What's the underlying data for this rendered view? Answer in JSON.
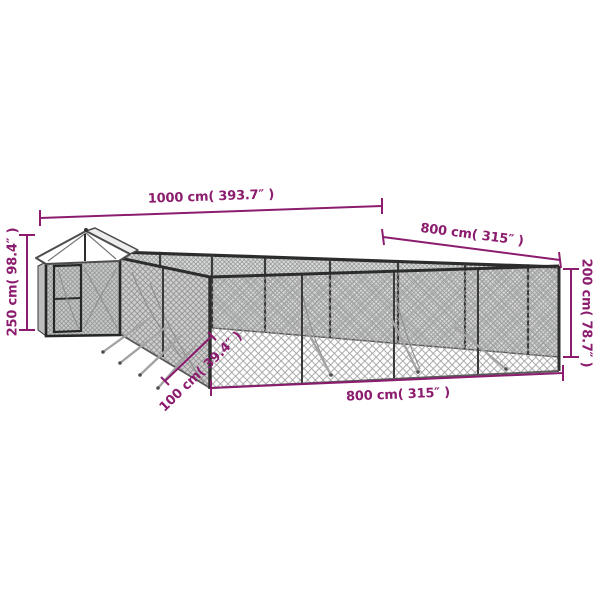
{
  "canvas": {
    "width": 600,
    "height": 600,
    "background_color": "#ffffff"
  },
  "diagram": {
    "illustration_name": "outdoor-chain-link-dog-kennel-with-gabled-roof-shelter",
    "accent_color": "#8b1c6e",
    "fence_mesh_color": "#9a9a9a",
    "frame_color": "#2c2c2c",
    "roof_color": "#ffffff",
    "dimensions": {
      "top_width": "1000 cm( 393.7″ )",
      "right_depth": "800 cm( 315″ )",
      "left_height": "250 cm( 98.4″ )",
      "right_height": "200 cm( 78.7″ )",
      "front_width": "800 cm( 315″ )",
      "left_depth": "100 cm( 39.4″ )"
    }
  }
}
